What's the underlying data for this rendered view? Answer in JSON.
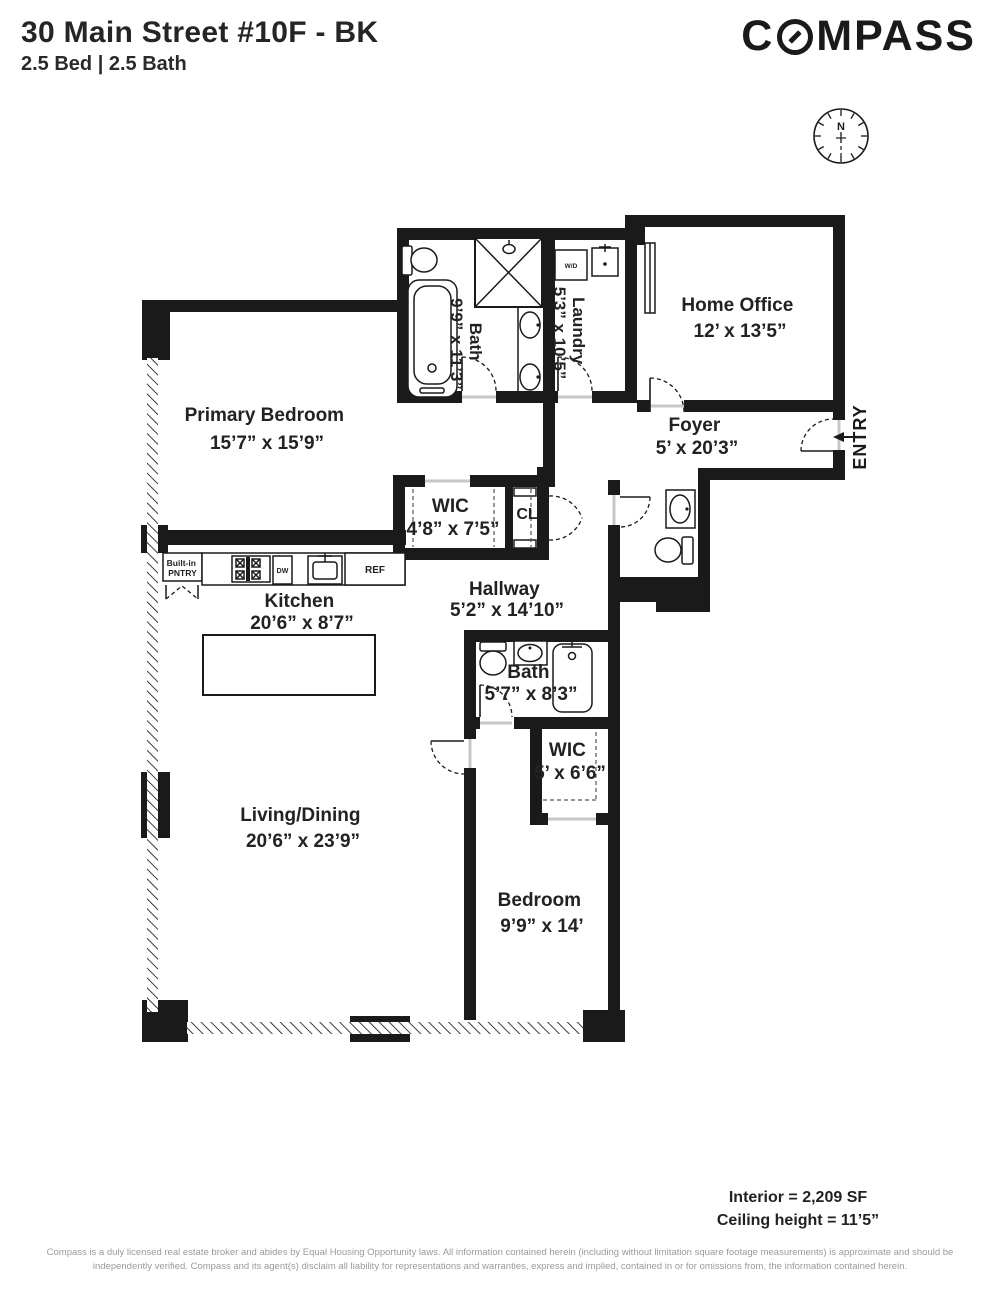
{
  "header": {
    "title": "30 Main Street #10F - BK",
    "subtitle": "2.5 Bed | 2.5 Bath",
    "brand": "COMPASS",
    "brand_prefix": "C",
    "brand_suffix": "MPASS"
  },
  "compass_rose": {
    "north_label": "N"
  },
  "rooms": {
    "primary_bedroom": {
      "name": "Primary Bedroom",
      "dims": "15’7” x 15’9”"
    },
    "bath_primary": {
      "name": "Bath",
      "dims": "9’9” x 11’3”"
    },
    "laundry": {
      "name": "Laundry",
      "dims": "5’3” x 10’5”"
    },
    "home_office": {
      "name": "Home Office",
      "dims": "12’ x 13’5”"
    },
    "foyer": {
      "name": "Foyer",
      "dims": "5’ x 20’3”"
    },
    "entry": {
      "name": "ENTRY"
    },
    "wic_primary": {
      "name": "WIC",
      "dims": "4’8” x 7’5”"
    },
    "closet": {
      "name": "CL"
    },
    "hallway": {
      "name": "Hallway",
      "dims": "5’2” x 14’10”"
    },
    "kitchen": {
      "name": "Kitchen",
      "dims": "20’6” x 8’7”"
    },
    "pantry": {
      "line1": "Built-in",
      "line2": "PNTRY"
    },
    "bath_second": {
      "name": "Bath",
      "dims": "5’7” x 8’3”"
    },
    "wic_second": {
      "name": "WIC",
      "dims": "5’ x 6’6”"
    },
    "living_dining": {
      "name": "Living/Dining",
      "dims": "20’6” x 23’9”"
    },
    "bedroom": {
      "name": "Bedroom",
      "dims": "9’9” x 14’"
    }
  },
  "appliances": {
    "washer_dryer": "W/D",
    "dishwasher": "DW",
    "refrigerator": "REF"
  },
  "footer": {
    "interior": "Interior = 2,209 SF",
    "ceiling": "Ceiling height = 11’5”",
    "disclaimer": "Compass is a duly licensed real estate broker and abides by Equal Housing Opportunity laws.  All information contained herein (including without limitation square footage measurements) is approximate and should be independently verified. Compass and its agent(s) disclaim all liability for representations and warranties, express and implied, contained in or for omissions from, the information contained herein."
  },
  "colors": {
    "wall": "#1a1a1a",
    "text": "#222222",
    "muted": "#9a9a9a"
  }
}
